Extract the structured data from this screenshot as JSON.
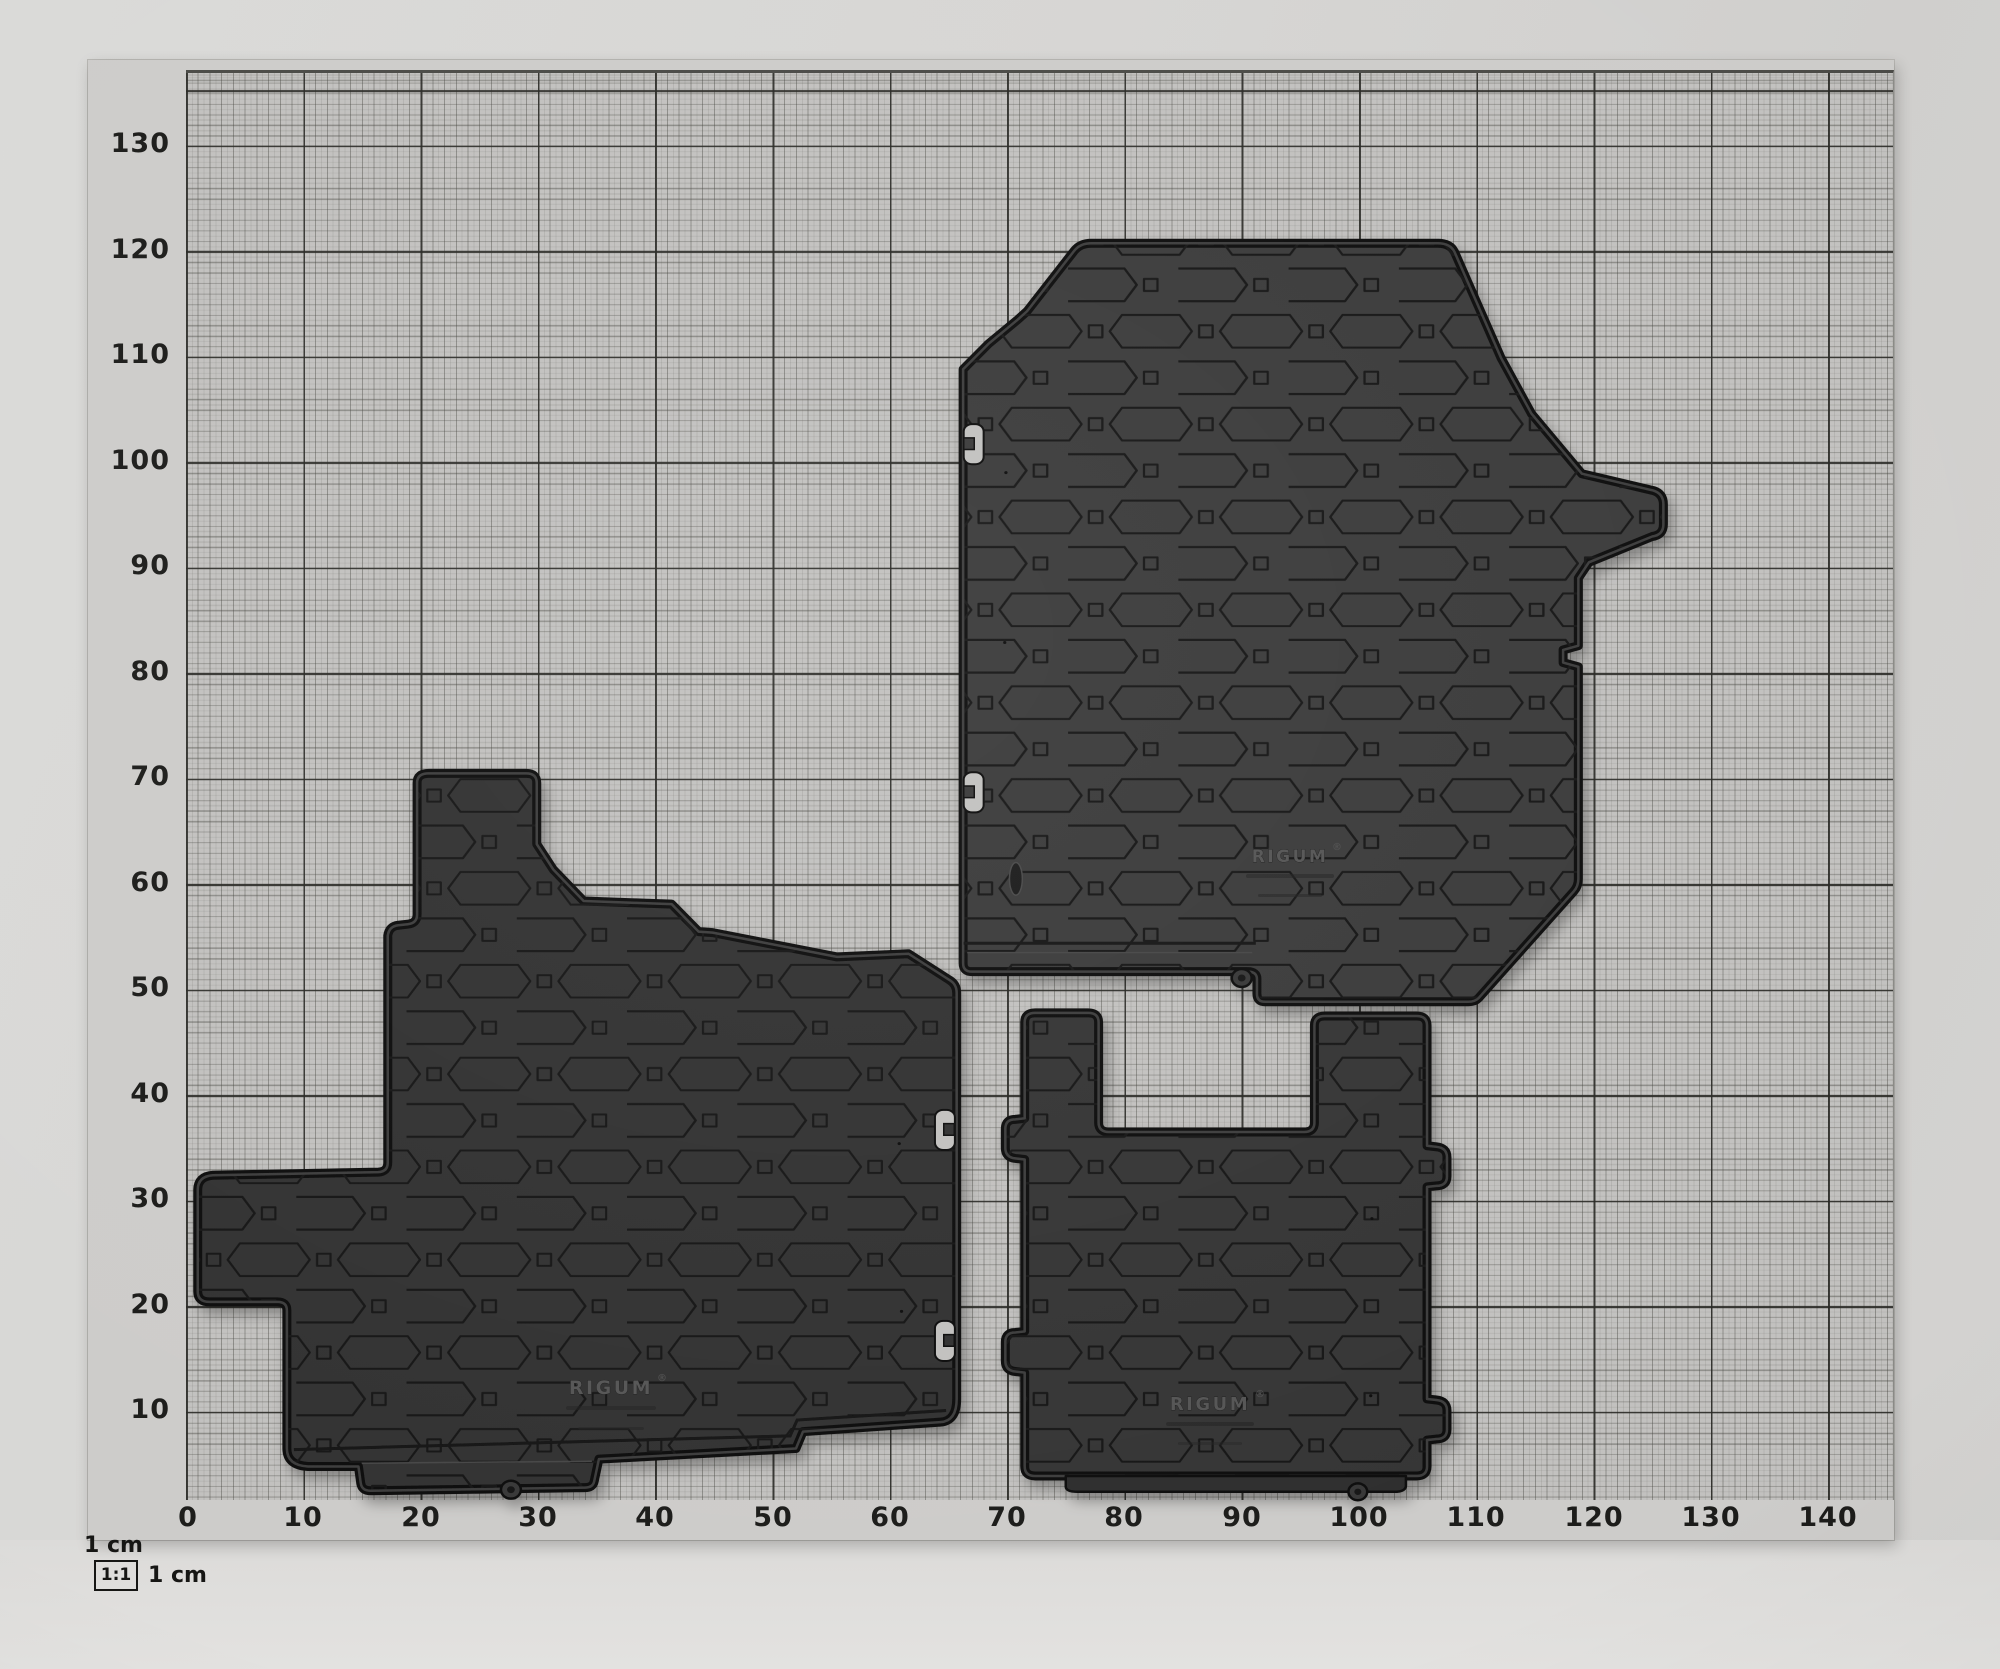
{
  "description": "Three black Rigum rubber car floor mats photographed on 1:1 scale centimetre graph paper",
  "axes": {
    "x_labels": [
      "0",
      "10",
      "20",
      "30",
      "40",
      "50",
      "60",
      "70",
      "80",
      "90",
      "100",
      "110",
      "120",
      "130",
      "140"
    ],
    "y_labels": [
      "130",
      "120",
      "110",
      "100",
      "90",
      "80",
      "70",
      "60",
      "50",
      "40",
      "30",
      "20",
      "10"
    ]
  },
  "footer": {
    "unit_label_top": "1 cm",
    "ratio_badge": "1:1",
    "unit_label_bottom": "1 cm"
  },
  "mats": {
    "front_left": {
      "brand": "RIGUM",
      "reg": "®",
      "position": "left large mat with footrest wing"
    },
    "front_right": {
      "brand": "RIGUM",
      "reg": "®",
      "position": "upper right mat with wheel-arch contour"
    },
    "rear": {
      "brand": "RIGUM",
      "reg": "®",
      "position": "lower right mat with U-shaped notch"
    }
  },
  "colors": {
    "backdrop": "#d6d5d3",
    "paper": "#cdccca",
    "grid_area": "#c2c1bf",
    "grid_major_line": "#28281f",
    "mat_base": "#343434",
    "mat_groove": "#151515",
    "logo_emboss": "#545454"
  }
}
